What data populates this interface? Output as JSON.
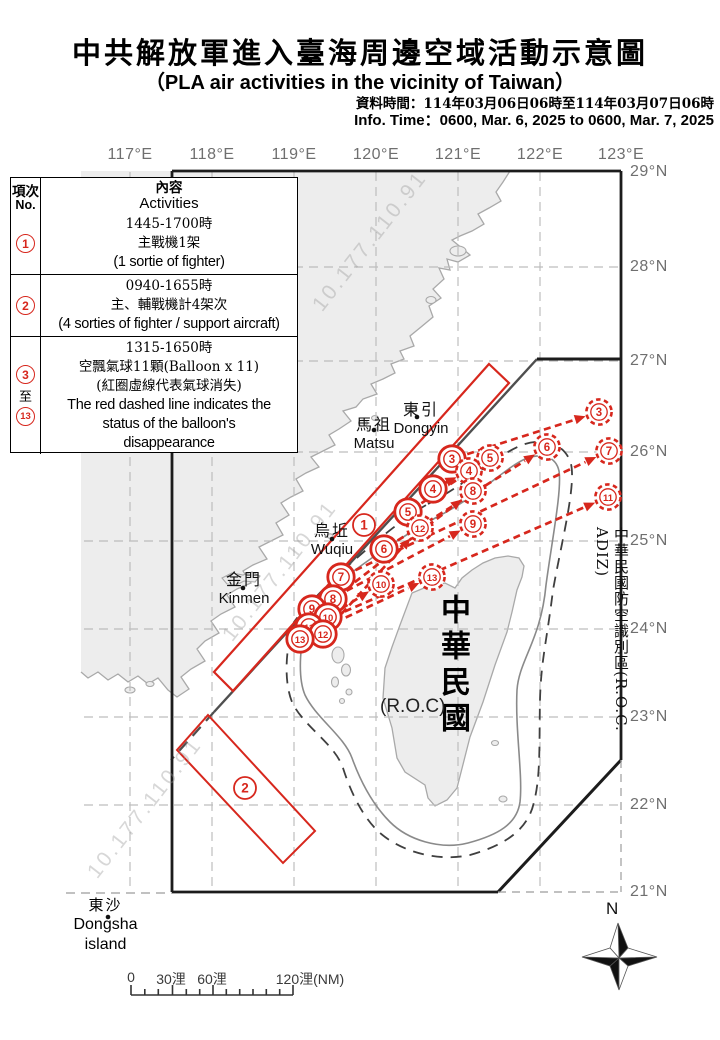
{
  "title": {
    "zh": "中共解放軍進入臺海周邊空域活動示意圖",
    "en": "（PLA air activities in the vicinity of Taiwan）",
    "info_zh": "資料時間：114年03月06日06時至114年03月07日06時",
    "info_en": "Info. Time：0600, Mar. 6, 2025 to 0600, Mar. 7, 2025"
  },
  "table": {
    "header": {
      "no_zh": "項次",
      "no_en": "No.",
      "content_zh": "內容",
      "content_en": "Activities"
    },
    "rows": [
      {
        "no": [
          {
            "circ": "1"
          }
        ],
        "lines": [
          {
            "t": "1445-1700時",
            "cls": "ln-zh"
          },
          {
            "t": "主戰機1架",
            "cls": "ln-zh"
          },
          {
            "t": "(1 sortie of fighter)",
            "cls": "ln-en"
          }
        ],
        "height": 61
      },
      {
        "no": [
          {
            "circ": "2"
          }
        ],
        "lines": [
          {
            "t": "0940-1655時",
            "cls": "ln-zh"
          },
          {
            "t": "主、輔戰機計4架次",
            "cls": "ln-zh"
          },
          {
            "t": "(4 sorties of fighter / support aircraft)",
            "cls": "ln-en"
          }
        ],
        "height": 62
      },
      {
        "no": [
          {
            "circ": "3"
          },
          {
            "plain": "至"
          },
          {
            "circ": "13"
          }
        ],
        "lines": [
          {
            "t": "1315-1650時",
            "cls": "ln-zh"
          },
          {
            "t": "空飄氣球11顆(Balloon x 11)",
            "cls": "ln-zh"
          },
          {
            "t": "(紅圈虛線代表氣球消失)",
            "cls": "ln-zh"
          },
          {
            "t": "The red dashed line indicates the",
            "cls": "ln-en"
          },
          {
            "t": "status of the balloon's",
            "cls": "ln-en"
          },
          {
            "t": "disappearance",
            "cls": "ln-en"
          }
        ],
        "height": 118
      }
    ]
  },
  "map": {
    "lon_labels": [
      {
        "t": "117°E",
        "x": 130
      },
      {
        "t": "118°E",
        "x": 212
      },
      {
        "t": "119°E",
        "x": 294
      },
      {
        "t": "120°E",
        "x": 376
      },
      {
        "t": "121°E",
        "x": 458
      },
      {
        "t": "122°E",
        "x": 540
      },
      {
        "t": "123°E",
        "x": 621
      }
    ],
    "lat_labels": [
      {
        "t": "29°N",
        "y": 172
      },
      {
        "t": "28°N",
        "y": 267
      },
      {
        "t": "27°N",
        "y": 361
      },
      {
        "t": "26°N",
        "y": 452
      },
      {
        "t": "25°N",
        "y": 541
      },
      {
        "t": "24°N",
        "y": 629
      },
      {
        "t": "23°N",
        "y": 717
      },
      {
        "t": "22°N",
        "y": 805
      },
      {
        "t": "21°N",
        "y": 892
      }
    ],
    "places": [
      {
        "id": "dongyin",
        "zh": "東引",
        "en": "Dongyin",
        "x": 421,
        "y": 396,
        "dot": [
          417,
          417
        ]
      },
      {
        "id": "matsu",
        "zh": "馬祖",
        "en": "Matsu",
        "x": 374,
        "y": 411,
        "dot": [
          374,
          430
        ]
      },
      {
        "id": "wuqiu",
        "zh": "烏坵",
        "en": "Wuqiu",
        "x": 332,
        "y": 517,
        "dot": [
          332,
          539
        ]
      },
      {
        "id": "kinmen",
        "zh": "金門",
        "en": "Kinmen",
        "x": 244,
        "y": 566,
        "dot": [
          243,
          588
        ]
      }
    ],
    "dongsha": {
      "zh": "東沙",
      "en1": "Dongsha",
      "en2": "island",
      "dot": [
        108,
        917
      ]
    },
    "roc_island": {
      "vertical": "中華民國",
      "paren": "(R.O.C)"
    },
    "adiz_label": "中華民國防空識別區(R.O.C. ADIZ)",
    "area_markers": [
      {
        "no": "1",
        "x": 364,
        "y": 525
      },
      {
        "no": "2",
        "x": 245,
        "y": 788
      }
    ],
    "balloons": [
      {
        "no": "3",
        "start": [
          452,
          459
        ],
        "end": [
          599,
          412
        ]
      },
      {
        "no": "4",
        "start": [
          433,
          489
        ],
        "end": [
          469,
          471
        ]
      },
      {
        "no": "5",
        "start": [
          408,
          512
        ],
        "end": [
          490,
          458
        ]
      },
      {
        "no": "6",
        "start": [
          384,
          549
        ],
        "end": [
          547,
          447
        ]
      },
      {
        "no": "7",
        "start": [
          341,
          577
        ],
        "end": [
          609,
          451
        ]
      },
      {
        "no": "8",
        "start": [
          333,
          599
        ],
        "end": [
          473,
          491
        ]
      },
      {
        "no": "9",
        "start": [
          312,
          609
        ],
        "end": [
          473,
          524
        ]
      },
      {
        "no": "10",
        "start": [
          328,
          617
        ],
        "end": [
          381,
          584
        ]
      },
      {
        "no": "11",
        "start": [
          309,
          627
        ],
        "end": [
          608,
          497
        ]
      },
      {
        "no": "12",
        "start": [
          323,
          634
        ],
        "end": [
          420,
          528
        ]
      },
      {
        "no": "13",
        "start": [
          300,
          639
        ],
        "end": [
          432,
          577
        ]
      }
    ],
    "watermark": "10.177.110.91",
    "compass_label": "N",
    "colors": {
      "red": "#d7271d",
      "land": "#ededed",
      "coast": "#a9a9a9",
      "grid": "#bdbdbd",
      "frame": "#1c1c1c",
      "median": "#4f4f4f"
    }
  },
  "scalebar": {
    "labels": [
      {
        "t": "0",
        "x": 131
      },
      {
        "t": "30浬",
        "x": 171
      },
      {
        "t": "60浬",
        "x": 212
      },
      {
        "t": "120浬(NM)",
        "x": 310
      }
    ]
  }
}
